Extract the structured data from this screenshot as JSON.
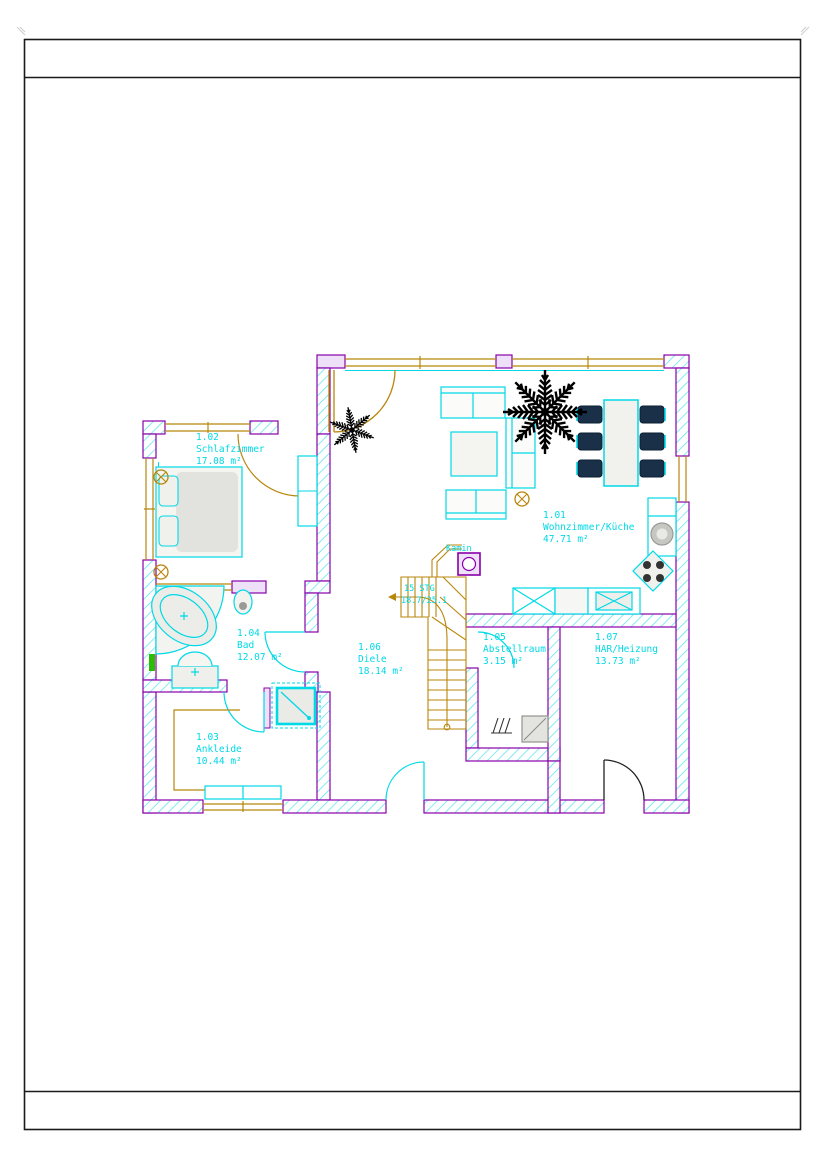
{
  "floorplan": {
    "rooms": [
      {
        "number": "1.02",
        "name": "Schlafzimmer",
        "area": "17.08 m²"
      },
      {
        "number": "1.01",
        "name": "Wohnzimmer/Küche",
        "area": "47.71 m²"
      },
      {
        "number": "1.04",
        "name": "Bad",
        "area": "12.07 m²"
      },
      {
        "number": "1.06",
        "name": "Diele",
        "area": "18.14 m²"
      },
      {
        "number": "1.05",
        "name": "Abstellraum",
        "area": "3.15 m²"
      },
      {
        "number": "1.07",
        "name": "HAR/Heizung",
        "area": "13.73 m²"
      },
      {
        "number": "1.03",
        "name": "Ankleide",
        "area": "10.44 m²"
      }
    ],
    "stairs_label": {
      "line1": "15 STG",
      "line2": "18.7/25.1"
    },
    "kamin_label": "Kamin",
    "colors": {
      "wall": "#8800aa",
      "wall_fill": "#efe0fa",
      "hatch": "#5ce4ef",
      "furniture": "#00d9e6",
      "wood": "#b8860b",
      "text": "#00d9e6",
      "chair": "#1a3049",
      "plant": "#000000",
      "accent_green": "#2dbd00"
    }
  }
}
